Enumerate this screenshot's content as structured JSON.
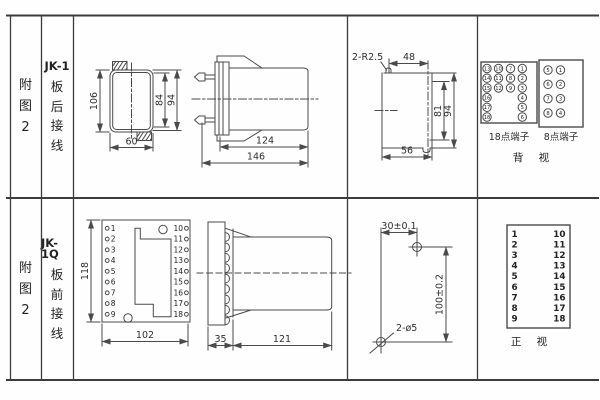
{
  "colors": {
    "line": "#4a4a4a",
    "text": "#2e2e2e",
    "background": "#ffffff"
  },
  "row1": {
    "fig_chars": [
      "附",
      "图",
      "2"
    ],
    "title": "JK-1",
    "title_chars": [
      "板",
      "后",
      "接",
      "线"
    ],
    "front_view": {
      "dim_height": "106",
      "dim_width": "60",
      "dim_inner": "84",
      "dim_outer": "94"
    },
    "side_view": {
      "dim_body": "124",
      "dim_total": "146"
    },
    "cutout_view": {
      "radius_note": "2-R2.5",
      "dim_top": "48",
      "dim_inner": "81",
      "dim_outer": "94",
      "dim_bottom": "56"
    },
    "terminal18": {
      "label": "18点端子",
      "columns": [
        [
          "13",
          "14",
          "15",
          "16",
          "17",
          "18"
        ],
        [
          "10",
          "11",
          "12"
        ],
        [
          "7",
          "8",
          "9"
        ],
        [
          "1",
          "2",
          "3",
          "4",
          "5",
          "6"
        ]
      ]
    },
    "terminal8": {
      "label": "8点端子",
      "columns": [
        [
          "5",
          "6",
          "7",
          "8"
        ],
        [
          "1",
          "2",
          "3",
          "4"
        ]
      ]
    },
    "view_label": "背 视"
  },
  "row2": {
    "fig_chars": [
      "附",
      "图",
      "2"
    ],
    "title": "JK-1Q",
    "title_chars": [
      "板",
      "前",
      "接",
      "线"
    ],
    "front_view": {
      "dim_height": "118",
      "dim_width": "102",
      "left_terminals": [
        "1",
        "2",
        "3",
        "4",
        "5",
        "6",
        "7",
        "8",
        "9"
      ],
      "right_terminals": [
        "10",
        "11",
        "12",
        "13",
        "14",
        "15",
        "16",
        "17",
        "18"
      ]
    },
    "side_view": {
      "dim_front": "35",
      "dim_body": "121"
    },
    "drill_view": {
      "dim_h": "30±0.1",
      "dim_v": "100±0.2",
      "hole_note": "2-ø5"
    },
    "terminal_table": {
      "left": [
        "1",
        "2",
        "3",
        "4",
        "5",
        "6",
        "7",
        "8",
        "9"
      ],
      "right": [
        "10",
        "11",
        "12",
        "13",
        "14",
        "15",
        "16",
        "17",
        "18"
      ]
    },
    "view_label": "正 视"
  }
}
